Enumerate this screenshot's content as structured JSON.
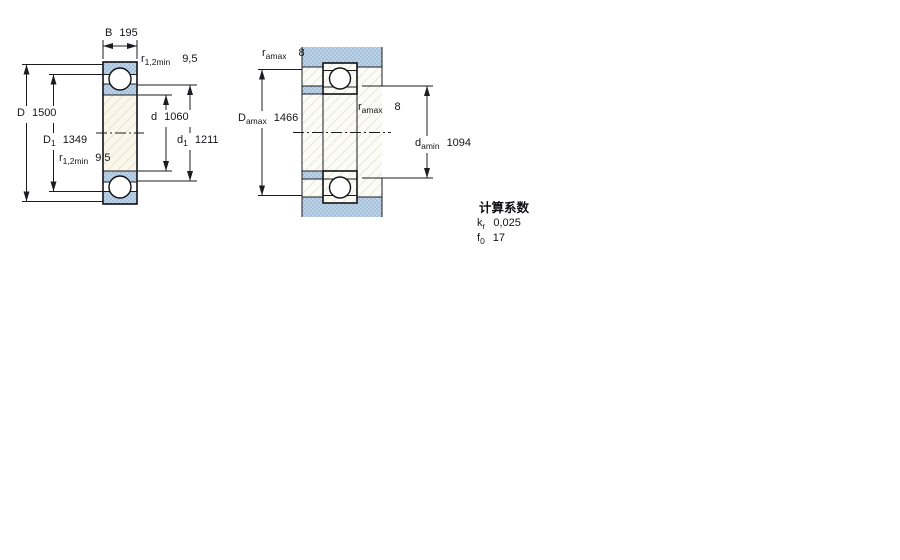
{
  "colors": {
    "background": "#ffffff",
    "line": "#1c1c22",
    "stipple_base": "#bdd2e4",
    "stipple_dot": "#8fb1d3",
    "cream_fill": "#fbf7ea",
    "drawing_white": "#fcfcf6"
  },
  "bearing_section": {
    "description": "bearing cross-section",
    "dims": {
      "B": {
        "sym": "B",
        "sub": "",
        "val": "195"
      },
      "r12_top": {
        "sym": "r",
        "sub": "1,2min",
        "val": "9,5"
      },
      "D": {
        "sym": "D",
        "sub": "",
        "val": "1500"
      },
      "D1": {
        "sym": "D",
        "sub": "1",
        "val": "1349"
      },
      "r12_bot": {
        "sym": "r",
        "sub": "1,2min",
        "val": "9,5"
      },
      "d": {
        "sym": "d",
        "sub": "",
        "val": "1060"
      },
      "d1": {
        "sym": "d",
        "sub": "1",
        "val": "1211"
      }
    }
  },
  "mounting": {
    "description": "abutment and fillet dimensions",
    "dims": {
      "ra_top": {
        "sym": "r",
        "sub": "amax",
        "val": "8"
      },
      "Da": {
        "sym": "D",
        "sub": "amax",
        "val": "1466"
      },
      "ra_right": {
        "sym": "r",
        "sub": "amax",
        "val": "8"
      },
      "da": {
        "sym": "d",
        "sub": "amin",
        "val": "1094"
      }
    }
  },
  "calculation_factors": {
    "title": "计算系数",
    "rows": [
      {
        "sym": "k",
        "sub": "r",
        "val": "0,025"
      },
      {
        "sym": "f",
        "sub": "0",
        "val": "17"
      }
    ]
  }
}
